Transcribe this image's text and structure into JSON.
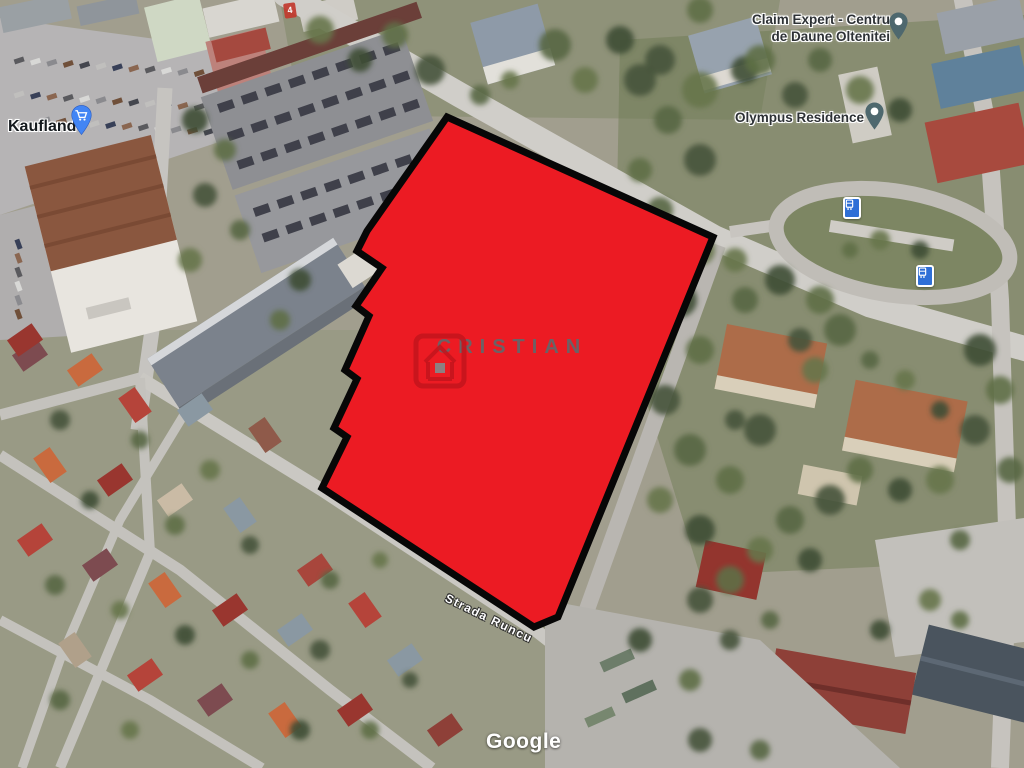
{
  "map": {
    "attribution": "Google",
    "street_label": "Strada Runcu",
    "route_marker": "4",
    "places": {
      "kaufland": {
        "name": "Kaufland",
        "pin_color": "#4285f4",
        "pin_icon": "shopping-cart"
      },
      "claim_expert": {
        "line1": "Claim Expert - Centru",
        "line2": "de Daune Oltenitei",
        "pin_color": "#4e686e",
        "pin_icon": "place"
      },
      "olympus": {
        "name": "Olympus Residence",
        "pin_color": "#4e686e",
        "pin_icon": "place"
      }
    },
    "transit_stops": [
      {
        "type": "tram-stop",
        "color": "#2f6fd6"
      },
      {
        "type": "tram-stop",
        "color": "#2f6fd6"
      }
    ]
  },
  "overlay": {
    "watermark_text": "CRISTIAN",
    "logo_icon": "house-logo",
    "fill_color": "#ec1b23",
    "outline_color": "#070707",
    "watermark_color": "#63676b"
  }
}
